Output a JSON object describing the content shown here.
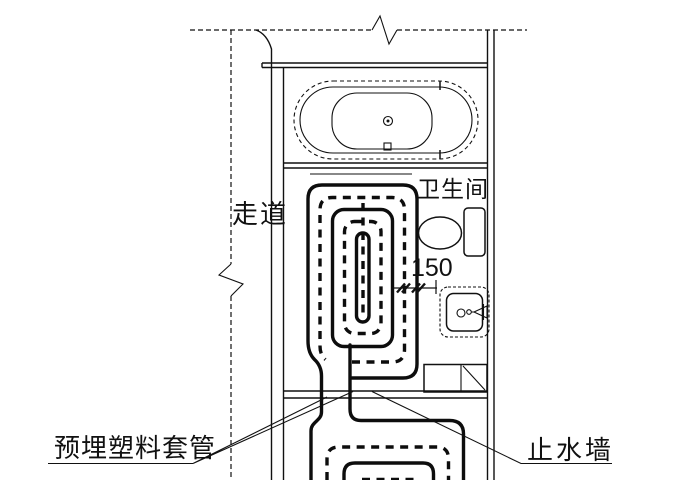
{
  "labels": {
    "corridor": "走道",
    "bathroom": "卫生间",
    "pipe_spacing": "150",
    "embedded_plastic_sleeve": "预埋塑料套管",
    "water_stop_wall": "止水墙"
  },
  "fixtures": [
    "bathtub",
    "toilet",
    "washbasin",
    "cabinet",
    "floor-heating-coil"
  ],
  "colors": {
    "line": "#111111",
    "pipe": "#0d0d0d",
    "background": "#ffffff"
  }
}
